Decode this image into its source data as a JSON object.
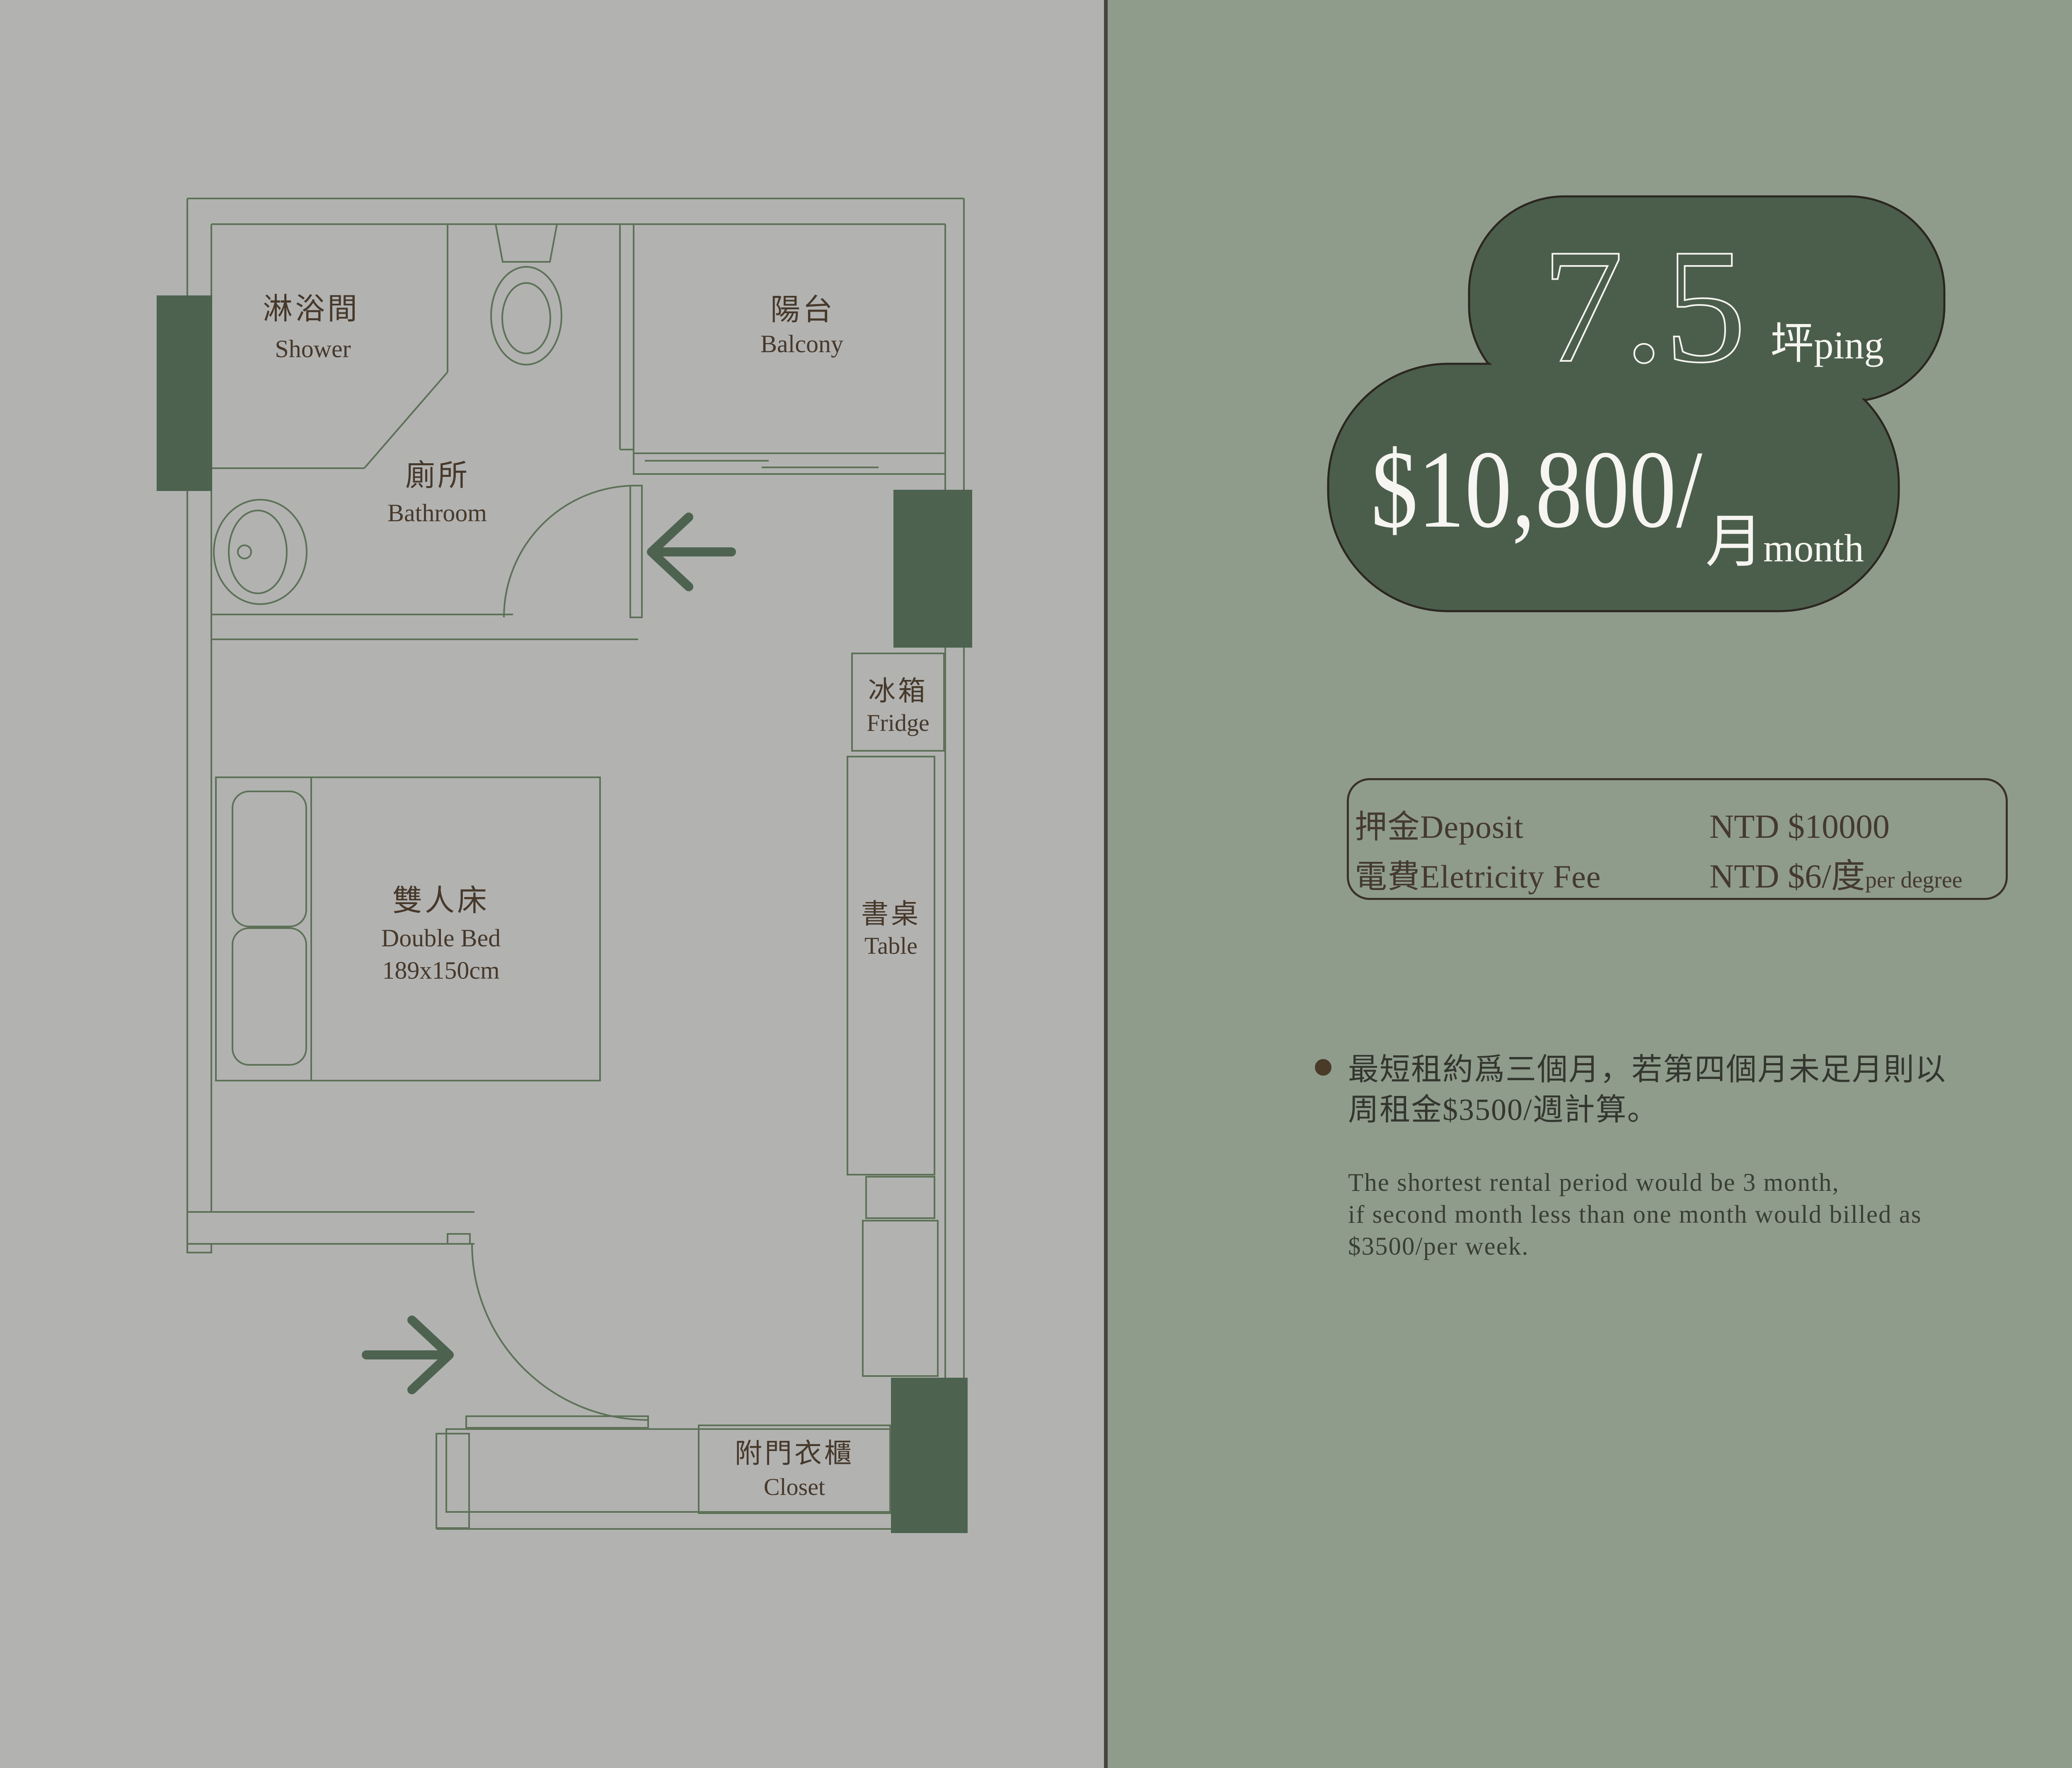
{
  "floor_plan": {
    "rooms": {
      "shower": {
        "zh": "淋浴間",
        "en": "Shower"
      },
      "bathroom": {
        "zh": "廁所",
        "en": "Bathroom"
      },
      "balcony": {
        "zh": "陽台",
        "en": "Balcony"
      },
      "bed": {
        "zh": "雙人床",
        "en": "Double Bed",
        "size": "189x150cm"
      },
      "fridge": {
        "zh": "冰箱",
        "en": "Fridge"
      },
      "table": {
        "zh": "書桌",
        "en": "Table"
      },
      "closet": {
        "zh": "附門衣櫃",
        "en": "Closet"
      }
    }
  },
  "summary": {
    "area_value": "7.5",
    "area_unit_zh": "坪",
    "area_unit_en": "ping",
    "price": "$10,800/",
    "price_unit_zh": "月",
    "price_unit_en": "month"
  },
  "fees": {
    "deposit_label": "押金Deposit",
    "deposit_value": "NTD $10000",
    "electricity_label": "電費Eletricity Fee",
    "electricity_value": "NTD $6/度",
    "electricity_value_suffix": "per degree"
  },
  "notes": {
    "zh_lines": [
      "最短租約爲三個月，若第四個月未足月則以",
      "周租金$3500/週計算。"
    ],
    "en_lines": [
      "The shortest rental period would be 3 month,",
      "if second month less than one month would billed as",
      "$3500/per week."
    ]
  },
  "colors": {
    "left_background": "#b2b2b1",
    "right_background": "#8f9c8c",
    "plan_line_green": "#5d7157",
    "solid_accent_green": "#4d6350",
    "label_brown": "#46392b",
    "blob_fill_green": "#4b5e4c",
    "blob_outline": "#2b2620",
    "white_text": "#f6f5f1",
    "box_outline_brown": "#3a3128"
  }
}
